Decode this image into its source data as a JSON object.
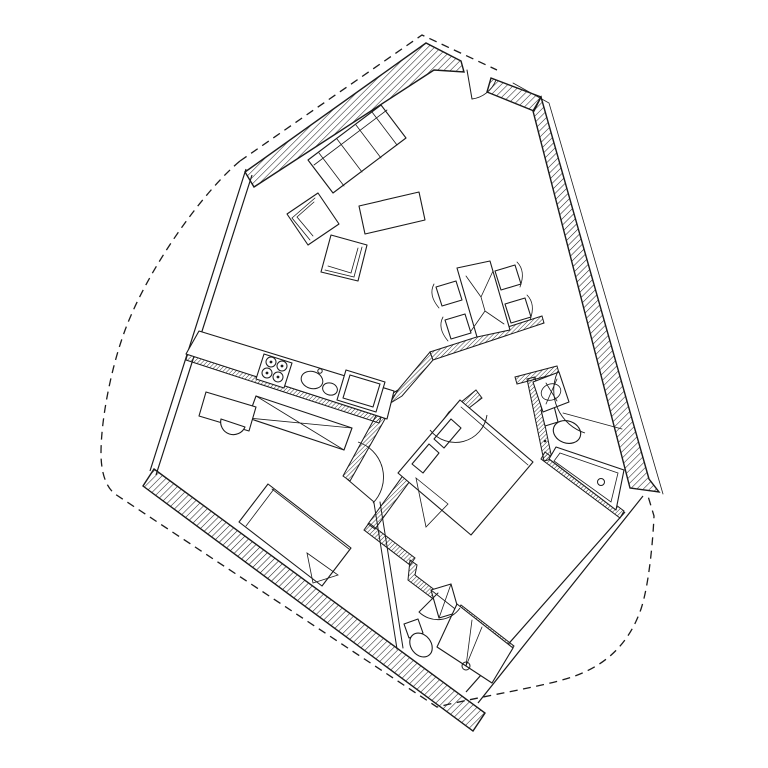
{
  "colors": {
    "ink": "#1a1a1a",
    "paper": "#ffffff"
  },
  "drawing": {
    "kind_legend": {
      "wall": "exterior structural wall (hatched)",
      "thin": "interior partition wall (hatched)",
      "glaze": "full-height glazing / thin wall (double line)",
      "dash": "site / property boundary",
      "furn": "furniture or fixture outline",
      "line": "detail line",
      "arc": "door swing arc",
      "dot": "solid detail dot"
    },
    "elements": [
      {
        "name": "site-boundary-dashed-west",
        "kind": "dash",
        "d": "M 240 161 C 205 190 152 262 127 325 C 111 366 101 420 101 453 C 101 473 106 487 115 494 L 437 707 C 482 696 542 687 572 677 C 611 664 631 638 641 609 C 649 585 653 540 654 516 L 648 496"
      },
      {
        "name": "site-boundary-dashed-north",
        "kind": "dash",
        "d": "M 240 161 L 422 35 L 497 70"
      },
      {
        "name": "roof-overhang-line-east",
        "kind": "fine",
        "d": "M 513 83 L 549 103 L 663 494"
      },
      {
        "name": "glazing-wall-west",
        "kind": "glaze",
        "d": "M 246 169 L 150 471 M 252 175 L 156 475"
      },
      {
        "name": "glazing-wall-southeast",
        "kind": "glaze",
        "d": "M 643 496 L 478 703 M 625 512 L 466 692"
      },
      {
        "name": "exterior-wall-northwest",
        "kind": "wall",
        "d": "M 245 172 L 426 43 L 461 61 L 464 72 L 434 70 L 254 187 Z"
      },
      {
        "name": "exterior-wall-entry-jamb",
        "kind": "wall",
        "d": "M 491 78 L 541 97 L 534 111 L 487 92 Z"
      },
      {
        "name": "exterior-wall-east",
        "kind": "wall",
        "d": "M 541 97 L 649 479 L 659 492 L 630 488 L 533 111 Z"
      },
      {
        "name": "exterior-wall-southwest",
        "kind": "wall",
        "d": "M 154 469 L 485 713 L 473 731 L 143 486 Z"
      },
      {
        "name": "partition-kitchen",
        "kind": "thin",
        "d": "M 188 352 L 382 415 L 379 423 L 186 360 Z"
      },
      {
        "name": "partition-corridor-west",
        "kind": "thin",
        "d": "M 378 412 L 385 419 L 350 481 L 343 476 Z"
      },
      {
        "name": "partition-bedroom-west",
        "kind": "thin",
        "d": "M 476 390 L 482 398 L 456 418 L 375 529 L 368 524 L 449 412 Z"
      },
      {
        "name": "partition-bedroom-south",
        "kind": "thin",
        "d": "M 369 523 L 415 558 L 410 565 L 364 530 Z"
      },
      {
        "name": "partition-bedroom-south-jog",
        "kind": "thin",
        "d": "M 410 560 L 417 565 L 415 575 L 440 594 L 436 601 L 408 580 Z"
      },
      {
        "name": "partition-bath2-north",
        "kind": "thin",
        "d": "M 461 605 L 514 646 L 510 653 L 457 612 Z"
      },
      {
        "name": "partition-dining",
        "kind": "thin",
        "d": "M 542 316 L 430 352 L 433 360 L 544 323 Z"
      },
      {
        "name": "partition-dining-return",
        "kind": "thin",
        "d": "M 430 352 L 433 360 L 402 396 L 384 407 L 380 401 L 398 390 Z"
      },
      {
        "name": "partition-corner-fan",
        "kind": "thin",
        "d": "M 398 390 L 380 401 L 387 408 Z"
      },
      {
        "name": "partition-bath1-north",
        "kind": "thin",
        "d": "M 515 377 L 557 366 L 559 373 L 517 384 Z"
      },
      {
        "name": "partition-bath1-west",
        "kind": "thin",
        "d": "M 527 379 L 535 377 L 552 459 L 544 461 Z"
      },
      {
        "name": "partition-bath1-south",
        "kind": "thin",
        "d": "M 545 452 L 624 511 L 620 518 L 541 459 Z"
      },
      {
        "name": "partition-bath2-west",
        "kind": "line",
        "d": "M 374 503 L 397 649 M 380 502 L 403 648"
      },
      {
        "name": "kitchen-counter",
        "kind": "furn",
        "d": "M 199 331 L 394 391 L 387 419 L 186 354 Z"
      },
      {
        "name": "wardrobe",
        "kind": "furn",
        "d": "M 256 396 L 352 428 L 344 450 L 248 418 Z"
      },
      {
        "name": "wardrobe-cross-lines",
        "kind": "fine",
        "d": "M 256 396 L 344 450 M 352 428 L 248 418"
      },
      {
        "name": "desk",
        "kind": "furn",
        "d": "M 206 392 L 256 407 L 249 431 L 199 416 Z"
      },
      {
        "name": "desk-chair",
        "kind": "furn",
        "d": "M 221 419 A 12.7 12.7 0 0 0 245 427 L 221 419 Z"
      },
      {
        "name": "fridge-cabinet",
        "kind": "furn",
        "d": "M 346 370 L 385 382 L 376 412 L 337 400 Z M 350 375 L 380 384 L 373 407 L 343 398 Z"
      },
      {
        "name": "stove",
        "kind": "furn",
        "d": "M 264 354 L 292 363 L 284 388 L 256 379 Z"
      },
      {
        "name": "stove-burner-1",
        "kind": "line",
        "shape": "circle",
        "cx": 271,
        "cy": 362,
        "r": 5
      },
      {
        "name": "stove-burner-2",
        "kind": "line",
        "shape": "circle",
        "cx": 282,
        "cy": 366,
        "r": 5
      },
      {
        "name": "stove-burner-3",
        "kind": "line",
        "shape": "circle",
        "cx": 267,
        "cy": 373,
        "r": 5
      },
      {
        "name": "stove-burner-4",
        "kind": "line",
        "shape": "circle",
        "cx": 278,
        "cy": 377,
        "r": 5
      },
      {
        "name": "stove-burner-dot-1",
        "kind": "dot",
        "shape": "circle",
        "cx": 271,
        "cy": 362,
        "r": 1.4
      },
      {
        "name": "stove-burner-dot-2",
        "kind": "dot",
        "shape": "circle",
        "cx": 282,
        "cy": 366,
        "r": 1.4
      },
      {
        "name": "stove-burner-dot-3",
        "kind": "dot",
        "shape": "circle",
        "cx": 267,
        "cy": 373,
        "r": 1.4
      },
      {
        "name": "stove-burner-dot-4",
        "kind": "dot",
        "shape": "circle",
        "cx": 278,
        "cy": 377,
        "r": 1.4
      },
      {
        "name": "kitchen-sink-basin-large",
        "kind": "line",
        "shape": "ellipse",
        "cx": 312,
        "cy": 380,
        "rx": 11,
        "ry": 8.5,
        "rot": 17
      },
      {
        "name": "kitchen-sink-basin-small",
        "kind": "line",
        "shape": "ellipse",
        "cx": 330,
        "cy": 389,
        "rx": 7.5,
        "ry": 6,
        "rot": 17
      },
      {
        "name": "kitchen-faucet",
        "kind": "line",
        "shape": "circle",
        "cx": 320,
        "cy": 371,
        "r": 2.2
      },
      {
        "name": "sofa",
        "kind": "furn",
        "d": "M 308 160 L 381 105 L 406 138 L 333 193 Z"
      },
      {
        "name": "sofa-cushion-lines",
        "kind": "fine",
        "d": "M 314 165 L 387 110 M 319 153 L 344 186 M 372 112 L 397 145 M 337 139 L 362 172 M 356 125 L 381 158"
      },
      {
        "name": "armchair-1",
        "kind": "furn",
        "d": "M 287 214 L 318 193 L 339 224 L 308 245 Z"
      },
      {
        "name": "armchair-1-back-lines",
        "kind": "fine",
        "d": "M 310 240 L 292 218 L 315 198 M 313 236 L 297 217 L 314 202"
      },
      {
        "name": "armchair-2",
        "kind": "furn",
        "d": "M 331 235 L 367 245 L 358 281 L 321 272 Z"
      },
      {
        "name": "armchair-2-back-lines",
        "kind": "fine",
        "d": "M 362 247 L 354 277 L 325 270 M 358 248 L 351 273 L 328 266"
      },
      {
        "name": "coffee-table",
        "kind": "furn",
        "d": "M 359 206 L 419 192 L 425 220 L 365 234 Z"
      },
      {
        "name": "dining-table",
        "kind": "furn",
        "d": "M 457 268 L 490 261 L 510 330 L 477 337 Z"
      },
      {
        "name": "dining-table-grain",
        "kind": "fine",
        "d": "M 466 276 L 481 297 M 493 271 L 481 297 M 481 297 L 483 304 M 471 331 L 485 311 M 504 324 L 485 311 M 485 311 L 483 304"
      },
      {
        "name": "dining-chair-1",
        "kind": "furn",
        "d": "M 436 287 L 456 281 L 462 300 L 442 306 Z"
      },
      {
        "name": "dining-chair-1-back",
        "kind": "fine",
        "d": "M 434 284 Q 428 295 439 308"
      },
      {
        "name": "dining-chair-2",
        "kind": "furn",
        "d": "M 445 320 L 465 314 L 471 333 L 451 339 Z"
      },
      {
        "name": "dining-chair-2-back",
        "kind": "fine",
        "d": "M 443 317 Q 437 328 448 341"
      },
      {
        "name": "dining-chair-3",
        "kind": "furn",
        "d": "M 495 271 L 515 265 L 521 284 L 501 290 Z"
      },
      {
        "name": "dining-chair-3-back",
        "kind": "fine",
        "d": "M 517 262 Q 526 271 520 287"
      },
      {
        "name": "dining-chair-4",
        "kind": "furn",
        "d": "M 505 304 L 525 298 L 531 317 L 511 323 Z"
      },
      {
        "name": "dining-chair-4-back",
        "kind": "fine",
        "d": "M 527 295 Q 536 304 530 320"
      },
      {
        "name": "single-bed",
        "kind": "furn",
        "d": "M 268 484 L 351 548 L 322 586 L 239 522 Z"
      },
      {
        "name": "single-bed-lines",
        "kind": "fine",
        "d": "M 274 489 L 246 526 M 272 489 L 349 549"
      },
      {
        "name": "single-bed-fold",
        "kind": "fine",
        "d": "M 307 553 L 338 575 L 313 583 Z"
      },
      {
        "name": "double-bed",
        "kind": "furn",
        "d": "M 398 473 L 460 400 L 533 462 L 471 535 Z"
      },
      {
        "name": "double-bed-inner-line",
        "kind": "fine",
        "d": "M 461 407 L 528 465"
      },
      {
        "name": "double-bed-pillows",
        "kind": "furn",
        "d": "M 412 464 L 429 444 L 439 453 L 423 473 Z M 434 439 L 451 419 L 461 428 L 444 448 Z"
      },
      {
        "name": "double-bed-fold",
        "kind": "fine",
        "d": "M 416 478 L 448 504 L 426 527 Z"
      },
      {
        "name": "bathtub",
        "kind": "furn",
        "d": "M 556 447 L 624 470 L 616 510 L 549 459 Z"
      },
      {
        "name": "bathtub-inner",
        "kind": "fine",
        "d": "M 560 453 L 618 473 L 611 502 L 554 461 Z"
      },
      {
        "name": "bathtub-drain",
        "kind": "line",
        "shape": "circle",
        "cx": 601,
        "cy": 482,
        "r": 3.5
      },
      {
        "name": "bath1-counter-line",
        "kind": "fine",
        "d": "M 563 413 L 622 429"
      },
      {
        "name": "toilet-1-tank",
        "kind": "furn",
        "d": "M 541 410 L 554 406 L 558 422 L 545 426 Z"
      },
      {
        "name": "toilet-1-bowl",
        "kind": "furn",
        "shape": "ellipse",
        "cx": 567,
        "cy": 432,
        "rx": 14,
        "ry": 11,
        "rot": 20
      },
      {
        "name": "toilet-1-button",
        "kind": "dot",
        "shape": "circle",
        "cx": 545,
        "cy": 441,
        "r": 1.3
      },
      {
        "name": "sink-1",
        "kind": "furn",
        "d": "M 533 382 L 559 372 L 569 402 L 543 412 Z"
      },
      {
        "name": "sink-1-basin",
        "kind": "fine",
        "shape": "ellipse",
        "cx": 551,
        "cy": 392,
        "rx": 10,
        "ry": 8,
        "rot": -21
      },
      {
        "name": "sink-1-tap-cross",
        "kind": "fine",
        "d": "M 546 383 L 557 401 M 557 379 L 546 404"
      },
      {
        "name": "toilet-2-tank",
        "kind": "furn",
        "d": "M 404 624 L 418 619 L 423 633 L 409 638 Z"
      },
      {
        "name": "toilet-2-bowl",
        "kind": "furn",
        "shape": "ellipse",
        "cx": 421,
        "cy": 645,
        "rx": 13,
        "ry": 10,
        "rot": 52
      },
      {
        "name": "sink-2",
        "kind": "furn",
        "d": "M 431 590 L 451 584 L 459 612 L 439 618 Z"
      },
      {
        "name": "sink-2-cross",
        "kind": "fine",
        "d": "M 431 590 L 459 612 M 451 584 L 439 618"
      },
      {
        "name": "shower-tray",
        "kind": "furn",
        "d": "M 457 604 L 513 648 L 492 683 L 437 647 Z"
      },
      {
        "name": "shower-drain",
        "kind": "line",
        "shape": "circle",
        "cx": 466,
        "cy": 666,
        "r": 4
      },
      {
        "name": "shower-lines",
        "kind": "fine",
        "d": "M 466 666 L 472 620 M 466 666 L 482 627"
      },
      {
        "name": "entry-door-arc",
        "kind": "arc",
        "d": "M 496 80 A 30 30 0 0 1 472 99"
      },
      {
        "name": "entry-door-leaf",
        "kind": "line",
        "d": "M 467 70 L 472 99"
      },
      {
        "name": "bedroom-door-arc",
        "kind": "arc",
        "d": "M 430 430 A 32 32 0 0 0 487 415"
      },
      {
        "name": "room2-door-arc",
        "kind": "arc",
        "d": "M 358 442 A 37 37 0 0 1 373 503"
      },
      {
        "name": "room2-door-leaf",
        "kind": "line",
        "d": "M 347 479 L 374 502"
      },
      {
        "name": "bath1-door-arc",
        "kind": "arc",
        "d": "M 558 371 A 45 45 0 0 0 585 433"
      },
      {
        "name": "bath2-door-arc",
        "kind": "arc",
        "d": "M 460 608 A 27 27 0 0 1 419 612"
      },
      {
        "name": "bath2-door-leaf",
        "kind": "line",
        "d": "M 438 593 L 419 612"
      }
    ]
  }
}
